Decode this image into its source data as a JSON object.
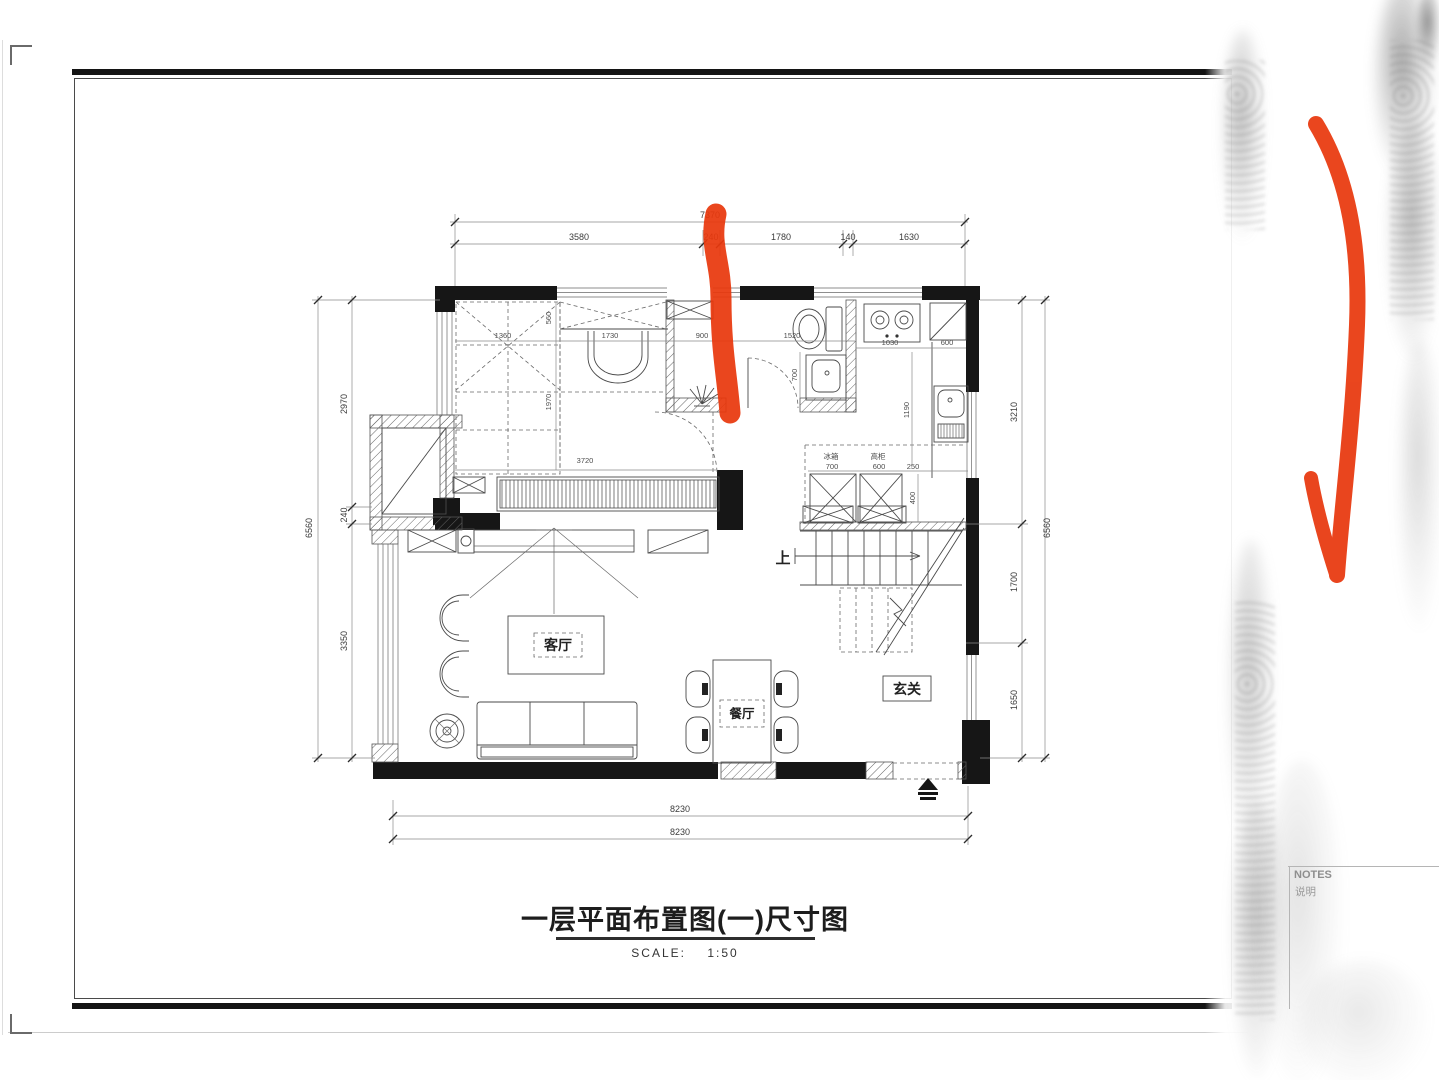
{
  "sheet": {
    "title": "一层平面布置图(一)尺寸图",
    "scale_label": "SCALE:",
    "scale_value": "1:50",
    "notes_label": "NOTES",
    "notes_sub": "说明"
  },
  "rooms": {
    "living": "客厅",
    "dining": "餐厅",
    "foyer": "玄关",
    "stairs_up": "上",
    "fridge": "冰箱",
    "tall_cabinet": "高柜"
  },
  "dims": {
    "top_total": "7370",
    "top": [
      "3580",
      "240",
      "1780",
      "140",
      "1630"
    ],
    "left_total": "6560",
    "left": [
      "2970",
      "240",
      "3350"
    ],
    "right_total": "6560",
    "right": [
      "3210",
      "1700",
      "1650"
    ],
    "bottom": [
      "8230",
      "8230"
    ],
    "inner": {
      "bed_left": "1360",
      "shelf": "560",
      "vanity": "1730",
      "hall": "900",
      "bath": "1520",
      "kitchen_a": "1030",
      "kitchen_b": "600",
      "bed_height": "1970",
      "bed_width": "3720",
      "bath_depth": "700",
      "kitchen_depth": "1190",
      "fridge_w": "700",
      "cabinet_w": "600",
      "gap": "250",
      "counter": "400"
    }
  },
  "colors": {
    "annotation_red": "#e8380d",
    "wall_black": "#161616"
  }
}
